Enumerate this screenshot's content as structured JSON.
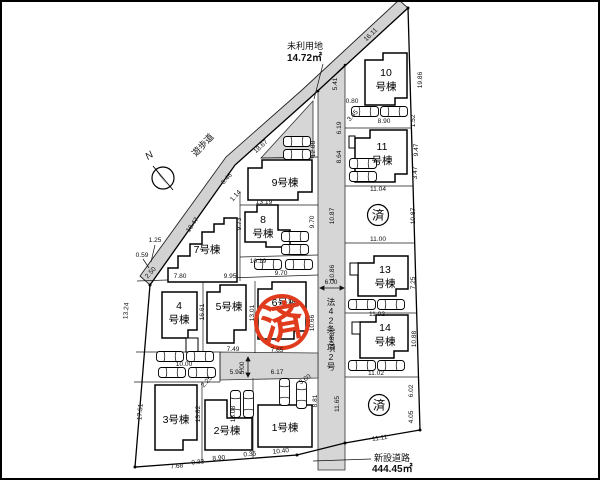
{
  "plan": {
    "compass": {
      "north_label": "N"
    },
    "walkway": {
      "label": "遊歩道"
    },
    "unused_land": {
      "name": "未利用地",
      "area": "14.72㎡"
    },
    "front_road": {
      "label": "法42条1項2号"
    },
    "new_road": {
      "name": "新設道路",
      "area": "444.45㎡"
    },
    "sold_label": "済",
    "stamp_label": "済",
    "buildings": {
      "b1": [
        "1号棟"
      ],
      "b2": [
        "2号棟"
      ],
      "b3": [
        "3号棟"
      ],
      "b4": [
        "4",
        "号棟"
      ],
      "b5": [
        "5号棟"
      ],
      "b6": [
        "6号棟"
      ],
      "b7": [
        "7号棟"
      ],
      "b8": [
        "8",
        "号棟"
      ],
      "b9": [
        "9号棟"
      ],
      "b10": [
        "10",
        "号棟"
      ],
      "b11": [
        "11",
        "号棟"
      ],
      "b13": [
        "13",
        "号棟"
      ],
      "b14": [
        "14",
        "号棟"
      ]
    },
    "dims": [
      "16.11",
      "18.67",
      "18.47",
      "5.41",
      "0.80",
      "6.19",
      "3.45",
      "8.90",
      "19.86",
      "1.52",
      "9.47",
      "3.47",
      "8.64",
      "11.04",
      "10.87",
      "10.87",
      "11.00",
      "10.86",
      "7.25",
      "11.02",
      "10.88",
      "10.88",
      "11.02",
      "11.65",
      "6.02",
      "4.05",
      "11.11",
      "6.00",
      "12.88",
      "10.66",
      "13.19",
      "9.73",
      "9.70",
      "10.19",
      "9.70",
      "6.46",
      "1.14",
      "1.25",
      "0.59",
      "2.50",
      "7.80",
      "9.95",
      "13.24",
      "16.61",
      "13.01",
      "7.49",
      "7.65",
      "10.00",
      "5.00",
      "5.97",
      "6.17",
      "2.25",
      "17.51",
      "13.82",
      "13.08",
      "3.60",
      "8.81",
      "7.68",
      "0.33",
      "8.90",
      "0.35",
      "10.40"
    ]
  },
  "colors": {
    "stamp_red": "#e03b1c",
    "road_gray": "#d6d6d6",
    "line": "#000000"
  }
}
